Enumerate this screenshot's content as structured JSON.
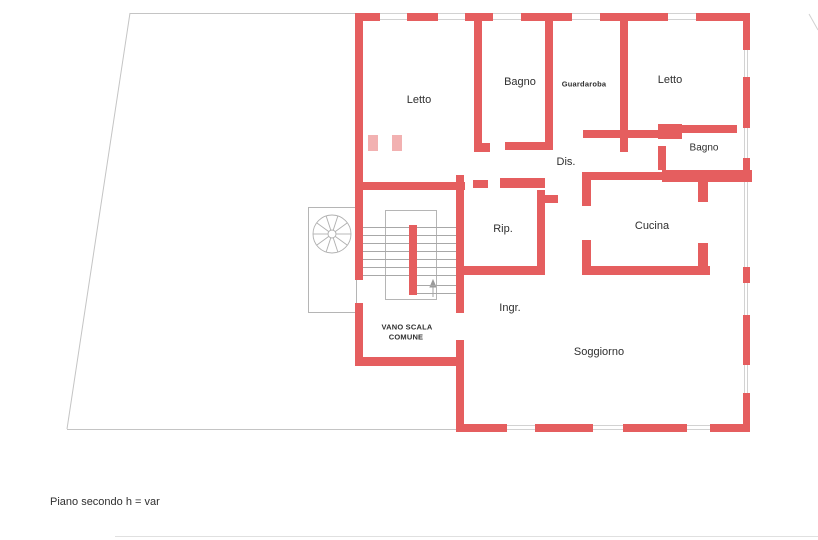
{
  "plan": {
    "rooms": [
      {
        "name": "letto-1",
        "label": "Letto"
      },
      {
        "name": "bagno-1",
        "label": "Bagno"
      },
      {
        "name": "guardaroba",
        "label": "Guardaroba"
      },
      {
        "name": "letto-2",
        "label": "Letto"
      },
      {
        "name": "bagno-2",
        "label": "Bagno"
      },
      {
        "name": "disimpegno",
        "label": "Dis."
      },
      {
        "name": "ripostiglio",
        "label": "Rip."
      },
      {
        "name": "cucina",
        "label": "Cucina"
      },
      {
        "name": "ingresso",
        "label": "Ingr."
      },
      {
        "name": "soggiorno",
        "label": "Soggiorno"
      }
    ],
    "stairwell": {
      "line1": "VANO SCALA",
      "line2": "COMUNE"
    },
    "caption": "Piano secondo h = var",
    "colors": {
      "wall": "#e55e5f",
      "wall_light": "#f2b1b1",
      "boundary_line": "#c4c4c4",
      "stair_line": "#a8a8a8",
      "text": "#2f2f2f",
      "background": "#ffffff"
    }
  }
}
